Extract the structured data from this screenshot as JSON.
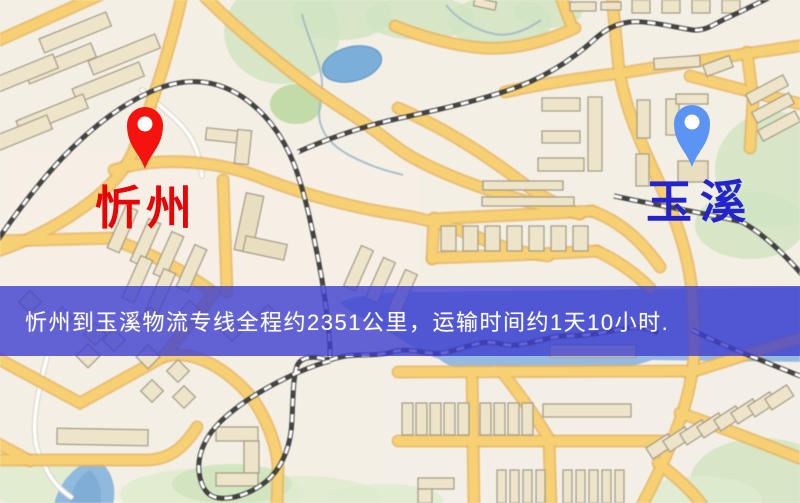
{
  "banner": {
    "text": "忻州到玉溪物流专线全程约2351公里，运输时间约1天10小时.",
    "distance_km": "2351",
    "transit_time": "1天10小时",
    "background": "#3E3ED0",
    "text_color": "#FFFFFF"
  },
  "origin": {
    "name": "忻州",
    "label_color": "#E60404",
    "pin_color": "#F2140D"
  },
  "destination": {
    "name": "玉溪",
    "label_color": "#2424CE",
    "pin_color": "#5B94F2"
  },
  "map_colors": {
    "background": "#F3EFE4",
    "road_fill": "#F8D06E",
    "road_casing": "#EAB258",
    "minor_road": "#FFFFFF",
    "railway": "#353535",
    "building": "#EDE4C8",
    "park": "#D2E5C0",
    "water": "#94B9E2",
    "pond": "#7AAEDC"
  },
  "icons": {
    "origin_pin": "map-pin",
    "destination_pin": "map-pin"
  }
}
